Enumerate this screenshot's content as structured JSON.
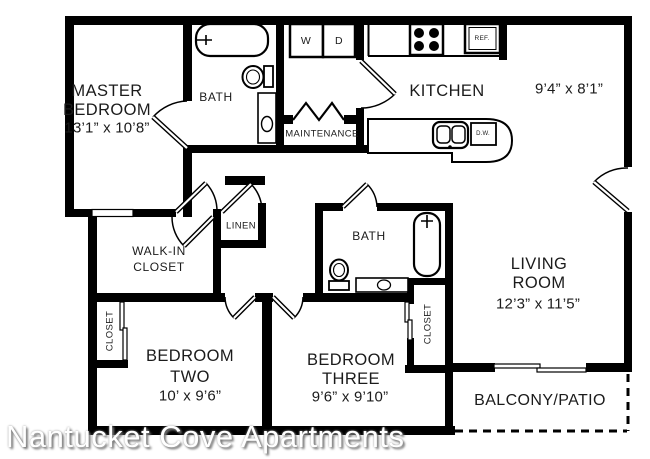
{
  "watermark": {
    "text": "Nantucket Cove Apartments"
  },
  "colors": {
    "wall": "#000000",
    "background": "#ffffff",
    "label": "#1b1b1b",
    "watermark": "#ffffff",
    "watermark_shadow": "#777777"
  },
  "rooms": {
    "master": {
      "line1": "MASTER",
      "line2": "BEDROOM",
      "dims": "13’1” x 10’8”"
    },
    "bath_top": {
      "name": "BATH"
    },
    "bath_mid": {
      "name": "BATH"
    },
    "kitchen": {
      "name": "KITCHEN"
    },
    "dining": {
      "name": "DINING",
      "dims": "9’4” x 8’1”"
    },
    "maintenance": {
      "name": "MAINTENANCE"
    },
    "linen": {
      "name": "LINEN"
    },
    "walk_in": {
      "line1": "WALK-IN",
      "line2": "CLOSET"
    },
    "living": {
      "line1": "LIVING",
      "line2": "ROOM",
      "dims": "12’3” x 11’5”"
    },
    "closet_left": {
      "name": "CLOSET"
    },
    "closet_right": {
      "name": "CLOSET"
    },
    "bedroom_two": {
      "line1": "BEDROOM",
      "line2": "TWO",
      "dims": "10’ x 9’6”"
    },
    "bedroom_three": {
      "line1": "BEDROOM",
      "line2": "THREE",
      "dims": "9’6” x 9’10”"
    },
    "balcony": {
      "name": "BALCONY/PATIO"
    }
  },
  "appliances": {
    "washer": "W",
    "dryer": "D",
    "refrigerator": "REF.",
    "dishwasher": "D.W."
  }
}
